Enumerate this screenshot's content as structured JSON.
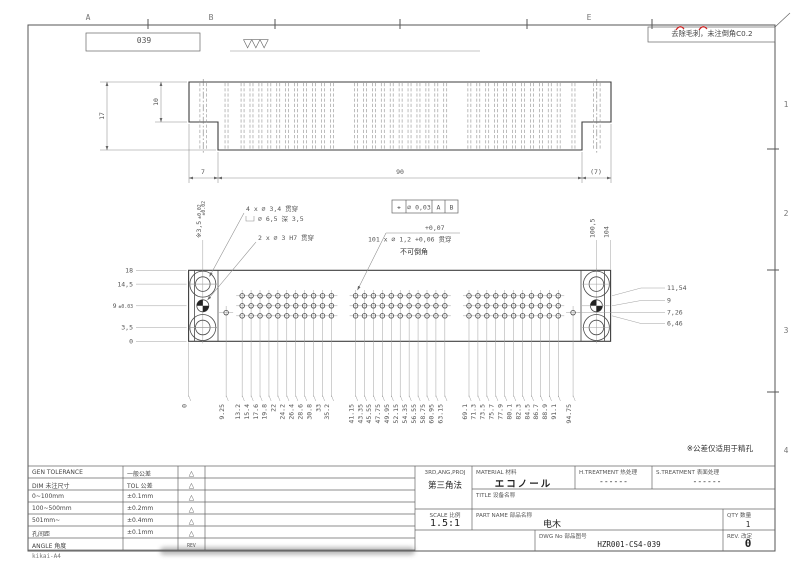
{
  "sheet": {
    "zone_columns": [
      "A",
      "B",
      "E"
    ],
    "zone_rows": [
      "1",
      "2",
      "3",
      "4"
    ],
    "corner_ref": "039",
    "surface_finish": "▽▽▽",
    "deburr_note": "去除毛刺，未注倒角C0.2",
    "footer_code": "kikai-A4"
  },
  "top_view": {
    "dim_height": "17",
    "dim_step_height": "10",
    "dim_left_step": "7",
    "dim_body": "90",
    "dim_right_step": "(7)",
    "dim_step_tol": "±0.02"
  },
  "front_view": {
    "callout_cb_line1": "4 x ∅ 3,4 贯穿",
    "callout_cb_line2": "∅ 6,5 深 3,5",
    "callout_dowel": "2 x ∅ 3 H7 贯穿",
    "callout_small_upper": "+0,07",
    "callout_small": "101 x ∅ 1,2 +0,06 贯穿",
    "callout_no_chamfer": "不可倒角",
    "fcf": {
      "symbol": "⌖",
      "tol": "∅ 0,03",
      "datum_a": "A",
      "datum_b": "B"
    },
    "tol_note": "※公差仅适用于精孔",
    "ordinates_bottom": [
      "0",
      "9.25",
      "13.2",
      "15.4",
      "17.6",
      "19.8",
      "22",
      "24.2",
      "26.4",
      "28.6",
      "30.8",
      "33",
      "35.2",
      "41.15",
      "43.35",
      "45.55",
      "47.75",
      "49.95",
      "52.15",
      "54.35",
      "56.55",
      "58.75",
      "60.95",
      "63.15",
      "69.1",
      "71.3",
      "73.5",
      "75.7",
      "77.9",
      "80.1",
      "82.3",
      "84.5",
      "86.7",
      "88.9",
      "91.1",
      "94.75"
    ],
    "ordinates_left": [
      {
        "label": "18",
        "tol": ""
      },
      {
        "label": "14,5",
        "tol": ""
      },
      {
        "label": "9",
        "tol": "±0.03"
      },
      {
        "label": "3,5",
        "tol": ""
      },
      {
        "label": "0",
        "tol": ""
      }
    ],
    "ordinates_right": [
      "11,54",
      "9",
      "7,26",
      "6,46"
    ],
    "ordinate_top_left": {
      "prefix": "※",
      "label": "3,5",
      "tol": "±0.02"
    },
    "ordinates_top_right": [
      "100,5",
      "104"
    ],
    "geometry": {
      "total_width_mm": 104,
      "block_height_mm": 18,
      "grid_rows_mm": [
        6.46,
        9,
        11.54
      ],
      "grid_columns_mm": [
        [
          13.2,
          15.4,
          17.6,
          19.8,
          22,
          24.2,
          26.4,
          28.6,
          30.8,
          33,
          35.2
        ],
        [
          41.15,
          43.35,
          45.55,
          47.75,
          49.95,
          52.15,
          54.35,
          56.55,
          58.75,
          60.95,
          63.15
        ],
        [
          69.1,
          71.3,
          73.5,
          75.7,
          77.9,
          80.1,
          82.3,
          84.5,
          86.7,
          88.9,
          91.1
        ]
      ],
      "single_holes_mm": [
        {
          "x": 9.25,
          "y": 7.26
        },
        {
          "x": 94.75,
          "y": 7.26
        }
      ],
      "cb_holes_x_mm": [
        3.5,
        100.5
      ],
      "cb_holes_y_mm": [
        3.5,
        14.5
      ],
      "dowel_y_mm": 9
    }
  },
  "title_block": {
    "projection_label": "3RD,ANG,PROJ",
    "projection_value": "第三角法",
    "scale_label": "SCALE 比例",
    "scale_value": "1.5:1",
    "material_label": "MATERIAL  材料",
    "material_value": "エコノール",
    "h_treatment_label": "H.TREATMENT  热处理",
    "h_treatment_value": "------",
    "s_treatment_label": "S.TREATMENT  表面处理",
    "s_treatment_value": "------",
    "title_label": "TITLE 设备名称",
    "title_value": "",
    "part_name_label": "PART NAME  部品名称",
    "part_name_value": "电木",
    "qty_label": "QTY 数量",
    "qty_value": "1",
    "dwg_no_label": "DWG No 部品图号",
    "dwg_no_value": "HZR001-CS4-039",
    "rev_label": "REV.  改定",
    "rev_value": "0"
  },
  "tolerance_table": {
    "rows": [
      [
        "GEN TOLERANCE",
        "一般公差"
      ],
      [
        "DIM 未注尺寸",
        "TOL 公差"
      ],
      [
        "0~100mm",
        "±0.1mm"
      ],
      [
        "100~500mm",
        "±0.2mm"
      ],
      [
        "501mm~",
        "±0.4mm"
      ],
      [
        "孔间距",
        "±0.1mm"
      ],
      [
        "ANGLE 角度",
        ""
      ]
    ],
    "rev_label": "REV"
  }
}
